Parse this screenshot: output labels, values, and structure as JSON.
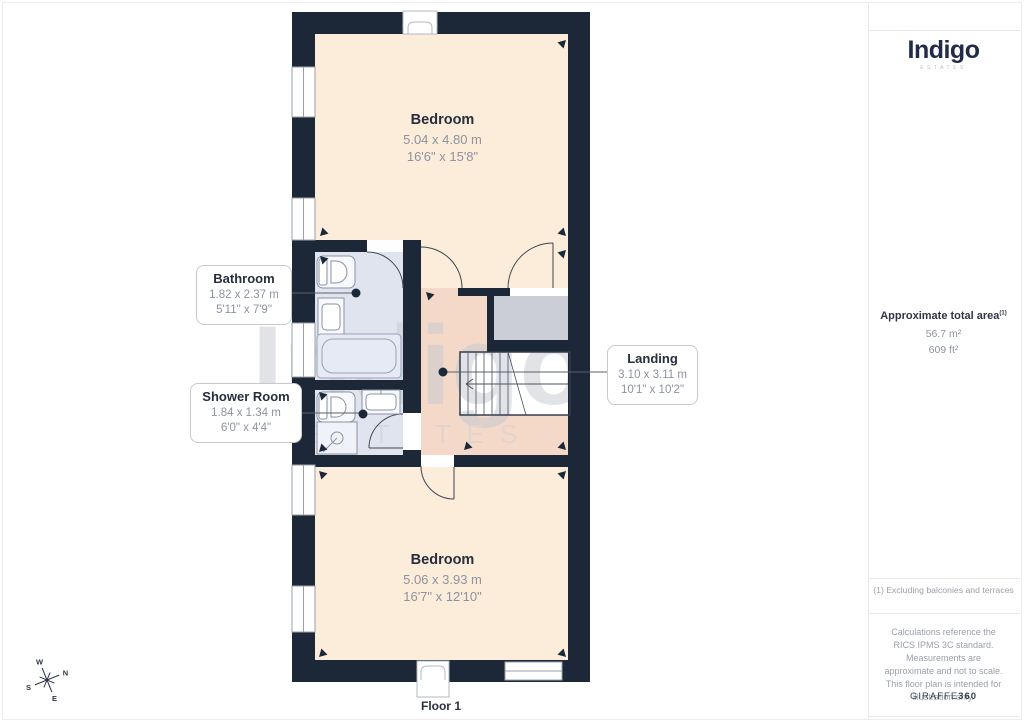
{
  "page": {
    "floor_label": "Floor 1"
  },
  "branding": {
    "logo_text": "Indigo",
    "logo_subtext": "ESTATES",
    "watermark_text": "Indigo",
    "watermark_subtext": "ESTATES",
    "giraffe_prefix": "GIRAFFE",
    "giraffe_suffix": "360"
  },
  "area_summary": {
    "title": "Approximate total area",
    "superscript": "(1)",
    "metric_value": "56.7 m²",
    "imperial_value": "609 ft²"
  },
  "footnotes": {
    "exclusion": "(1) Excluding balconies and terraces",
    "disclaimer": "Calculations reference the RICS IPMS 3C standard. Measurements are approximate and not to scale. This floor plan is intended for illustration only."
  },
  "rooms": {
    "bedroom_top": {
      "name": "Bedroom",
      "metric": "5.04 x 4.80 m",
      "imperial": "16'6\" x 15'8\""
    },
    "bathroom": {
      "name": "Bathroom",
      "metric": "1.82 x 2.37 m",
      "imperial": "5'11\" x 7'9\""
    },
    "shower_room": {
      "name": "Shower Room",
      "metric": "1.84 x 1.34 m",
      "imperial": "6'0\" x 4'4\""
    },
    "landing": {
      "name": "Landing",
      "metric": "3.10 x 3.11 m",
      "imperial": "10'1\" x 10'2\""
    },
    "bedroom_bottom": {
      "name": "Bedroom",
      "metric": "5.06 x 3.93 m",
      "imperial": "16'7\" x 12'10\""
    }
  },
  "compass": {
    "north": "N",
    "east": "E",
    "south": "S",
    "west": "W"
  },
  "colors": {
    "wall": "#1c2837",
    "room_cream": "#fcecda",
    "room_pink": "#f4d9c9",
    "room_blue": "#e0e4ef",
    "storage_gray": "#cbced6"
  }
}
